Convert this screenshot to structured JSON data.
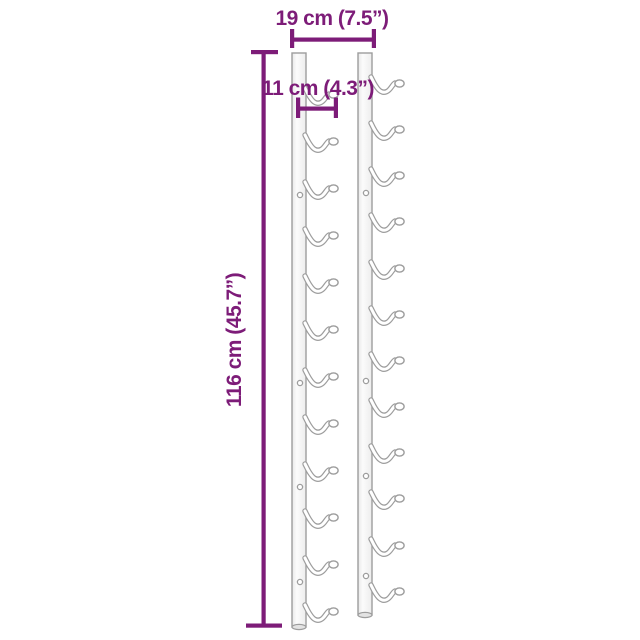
{
  "dimensions": {
    "width_label": "19 cm (7.5”)",
    "depth_label": "11 cm (4.3”)",
    "height_label": "116 cm (45.7”)"
  },
  "figure": {
    "rail_count": 2,
    "hooks_per_rail": 12,
    "rails": [
      {
        "name": "left",
        "x": 292,
        "top": 53,
        "bottom": 627,
        "width": 14,
        "hook_ys": [
          90,
          137,
          184,
          231,
          278,
          325,
          372,
          419,
          466,
          513,
          560,
          607
        ],
        "hole_ys": [
          195,
          383,
          487,
          582
        ]
      },
      {
        "name": "right",
        "x": 358,
        "top": 53,
        "bottom": 615,
        "width": 14,
        "hook_ys": [
          79,
          125,
          171,
          217,
          264,
          310,
          356,
          402,
          448,
          494,
          541,
          587
        ],
        "hole_ys": [
          193,
          381,
          476,
          576
        ]
      }
    ]
  },
  "colors": {
    "dimension_lines": "#7d1c78",
    "product_outline": "#9d9d9d",
    "rail_fill_light": "#f6f6f6",
    "background": "#ffffff"
  }
}
